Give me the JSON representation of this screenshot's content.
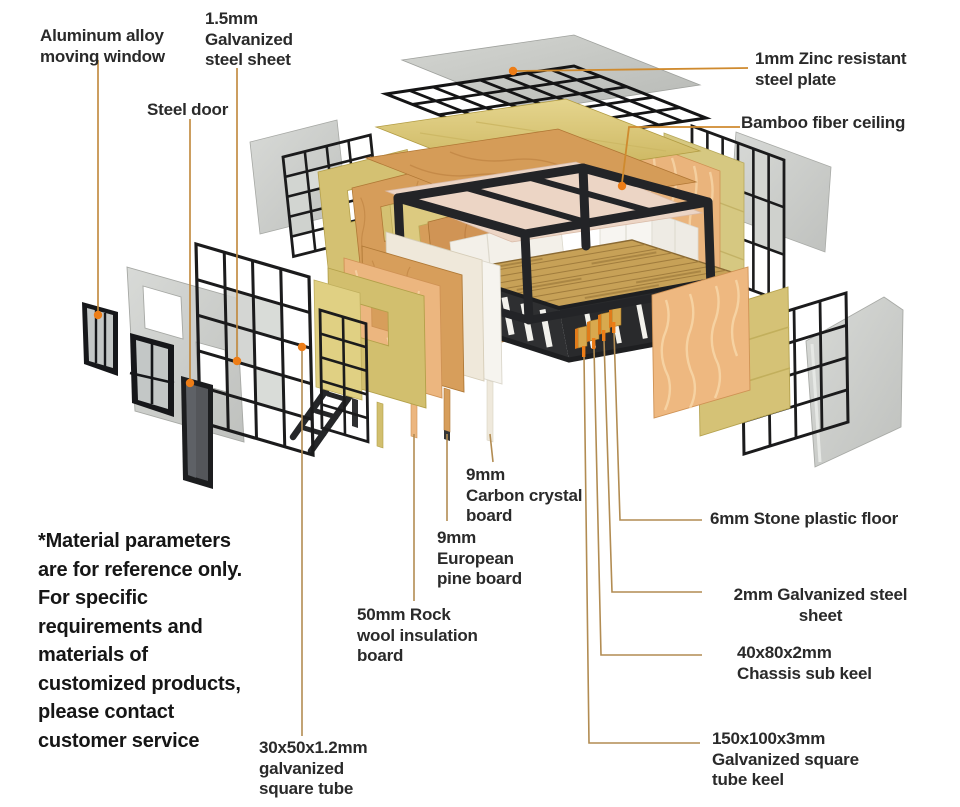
{
  "diagram": {
    "subject": "container-house-exploded-view",
    "callouts": {
      "aluminum_window": "Aluminum alloy\nmoving window",
      "galvanized_sheet_1_5": "1.5mm\nGalvanized\nsteel sheet",
      "steel_door": "Steel door",
      "zinc_plate": "1mm Zinc resistant\nsteel plate",
      "bamboo_ceiling": "Bamboo fiber ceiling",
      "carbon_crystal": "9mm\nCarbon crystal\nboard",
      "european_pine": "9mm\nEuropean\npine board",
      "rock_wool": "50mm Rock\nwool insulation\nboard",
      "stone_floor": "6mm Stone plastic floor",
      "galvanized_sheet_2": "2mm Galvanized steel\nsheet",
      "chassis_keel": "40x80x2mm\nChassis sub keel",
      "tube_keel": "150x100x3mm\nGalvanized square\ntube keel",
      "square_tube": "30x50x1.2mm\ngalvanized\nsquare tube"
    },
    "note": "*Material parameters\nare for reference only.\nFor specific\nrequirements and\nmaterials of\ncustomized products,\nplease contact\ncustomer service",
    "colors": {
      "leader_line": "#b28c52",
      "leader_line_orange": "#cf8a2e",
      "marker_dot": "#ed7d17",
      "text": "#2a2a2a",
      "steel_frame": "#232427",
      "wood_floor": "#c7a157",
      "osb_board": "#d69d5a",
      "gold_board": "#d4c172",
      "rock_wool": "#ecb67f",
      "white_panel": "#f4f1ea",
      "gray_panel": "#c9cbc7",
      "ceiling_panel": "#ecd5c5"
    }
  }
}
